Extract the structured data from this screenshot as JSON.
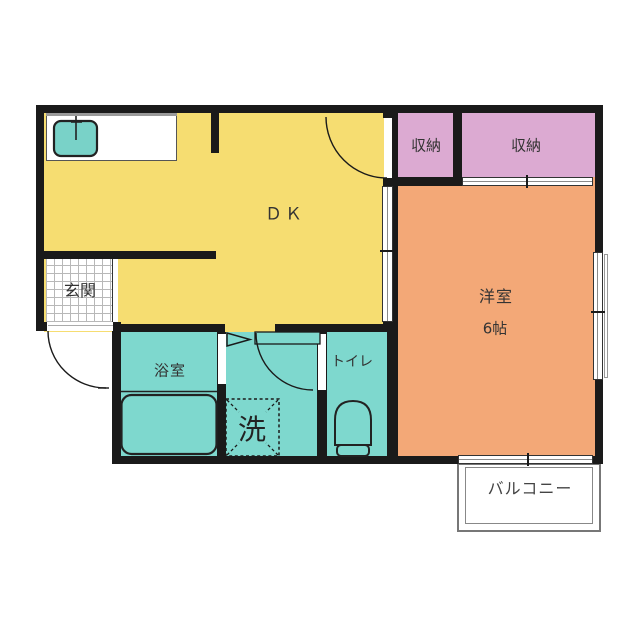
{
  "plan_title": "1DK apartment floor plan",
  "rooms": {
    "dk": {
      "label": "ＤＫ",
      "color": "#f6dd71"
    },
    "western": {
      "label": "洋室",
      "size_label": "6帖",
      "color": "#f3a877"
    },
    "closet_left": {
      "label": "収納",
      "color": "#dcaad2"
    },
    "closet_right": {
      "label": "収納",
      "color": "#dcaad2"
    },
    "entrance": {
      "label": "玄関",
      "color": "#ffffff"
    },
    "bathroom": {
      "label": "浴室",
      "color": "#7ed8ce"
    },
    "washroom": {
      "laundry_label": "洗",
      "color": "#7ed8ce"
    },
    "toilet": {
      "label": "トイレ",
      "color": "#7ed8ce"
    },
    "balcony": {
      "label": "バルコニー",
      "color": "#ffffff"
    }
  },
  "colors": {
    "wall": "#1a1a1a",
    "fixture_outline": "#222222",
    "sink": "#79d2c8",
    "text": "#333333"
  }
}
